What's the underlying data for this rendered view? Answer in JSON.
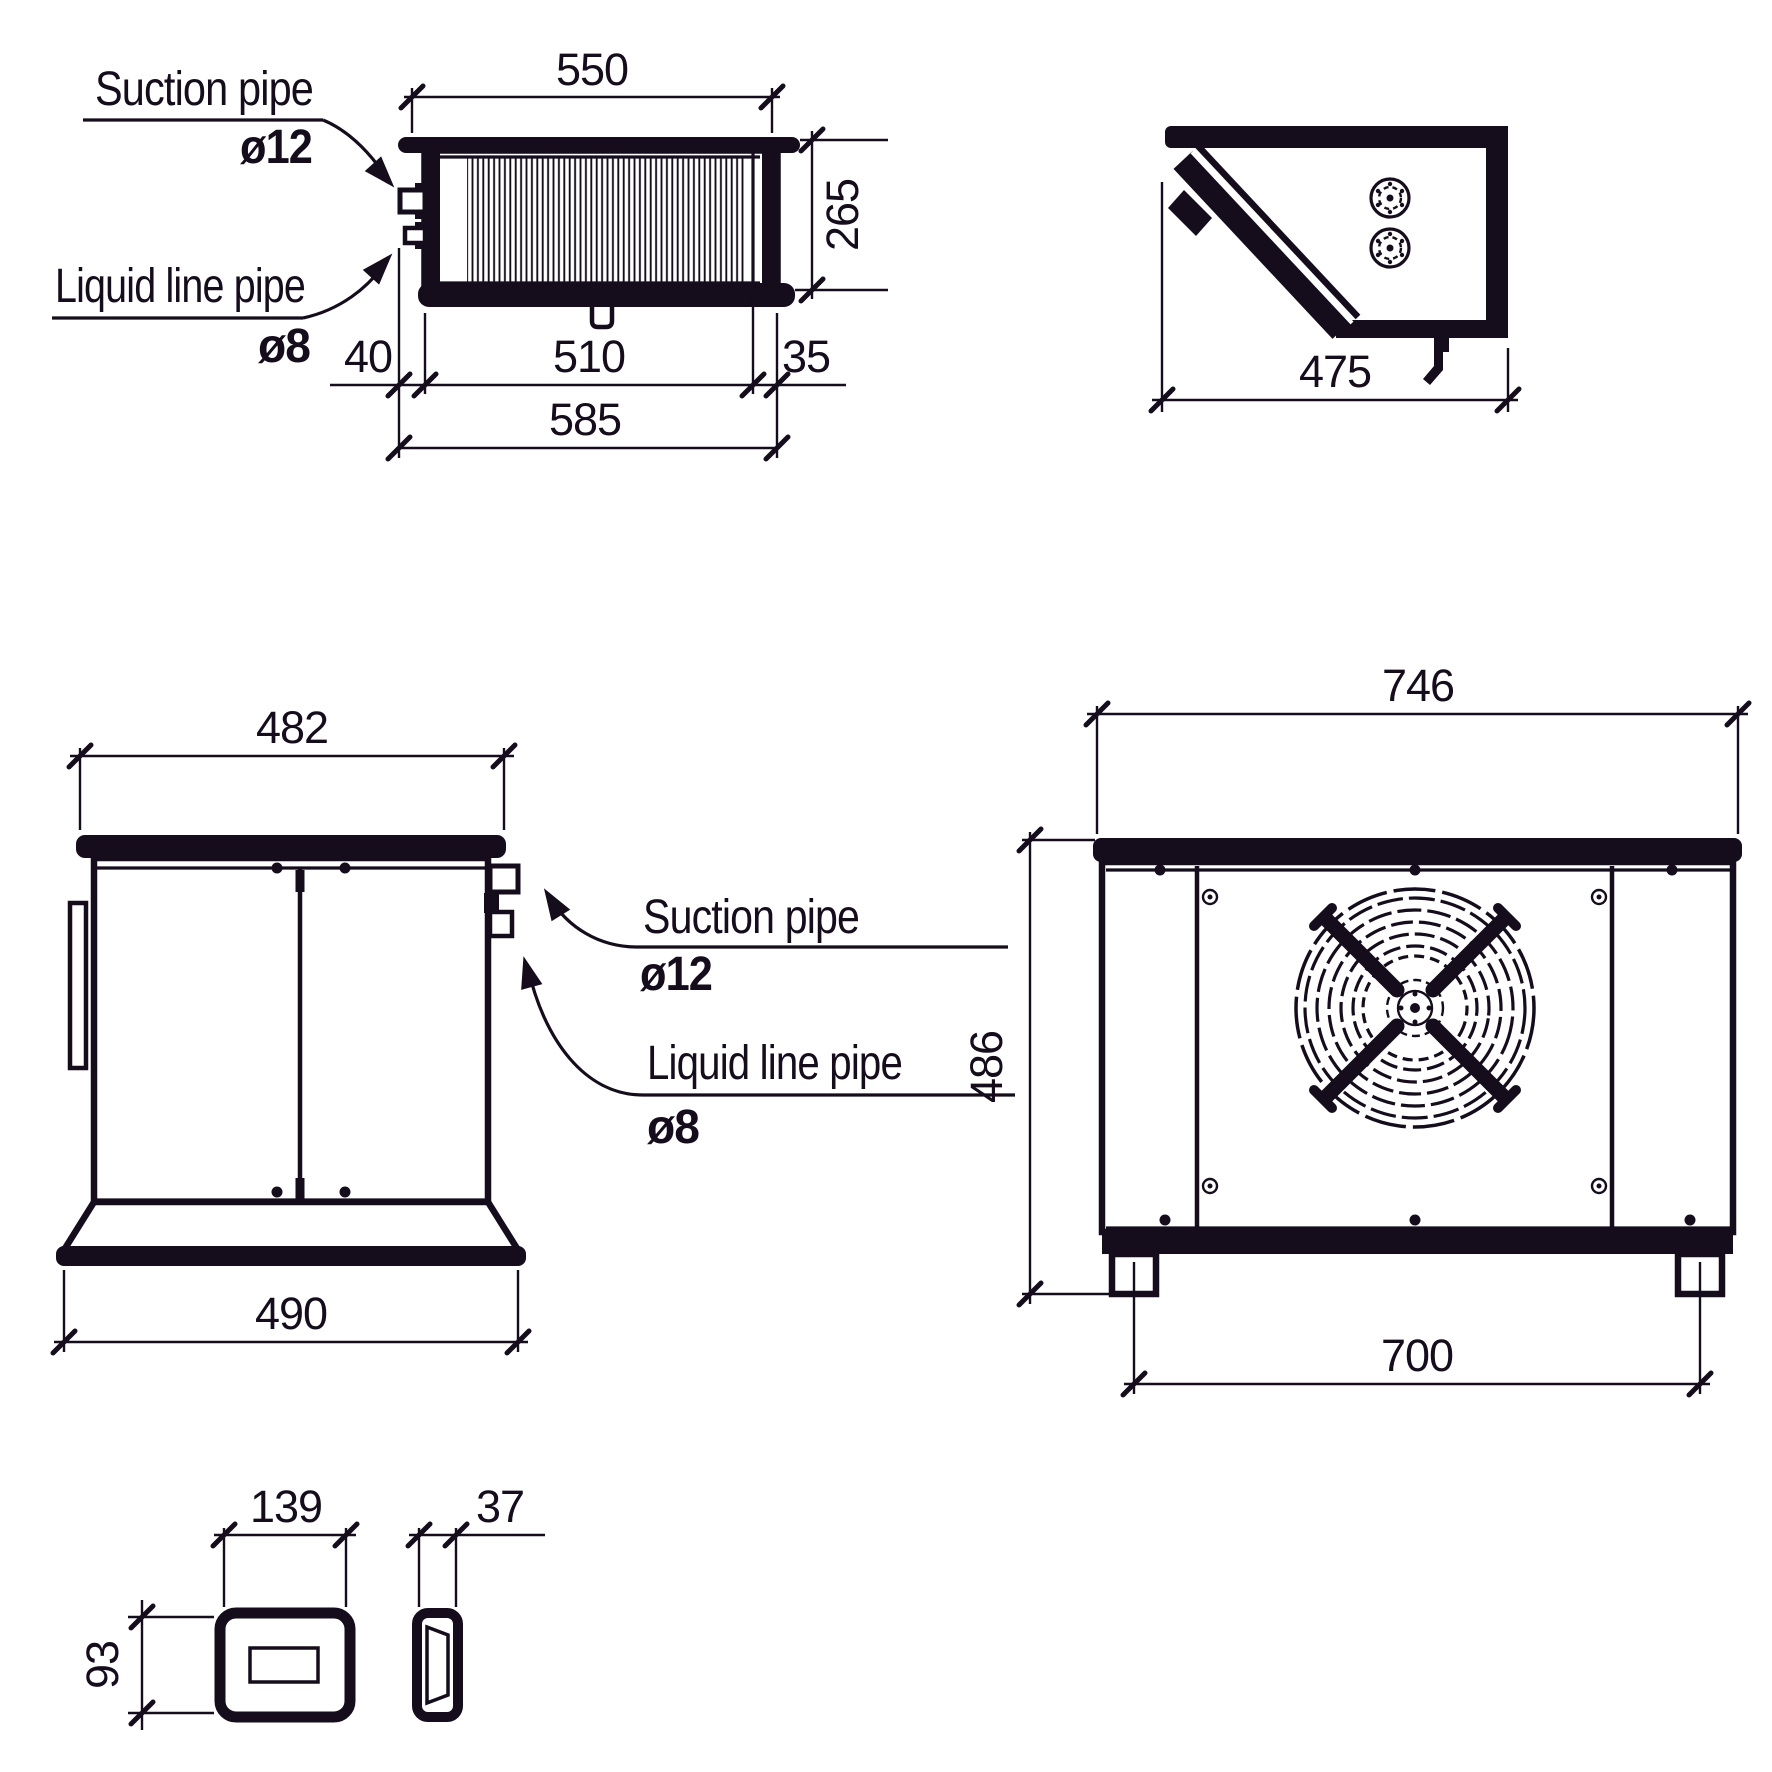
{
  "drawing_type": "technical-dimension-drawing",
  "ink_color": "#150d1c",
  "paper_color": "#ffffff",
  "views": {
    "evaporator_front": {
      "name": "Evaporator unit - front view",
      "labels": {
        "suction": "Suction pipe",
        "suction_diameter": "ø12",
        "liquid": "Liquid line pipe",
        "liquid_diameter": "ø8"
      },
      "dimensions": {
        "coil_width": "550",
        "height": "265",
        "pipe_offset": "40",
        "coil_length": "510",
        "end_margin": "35",
        "overall_width": "585"
      }
    },
    "evaporator_side": {
      "name": "Evaporator unit - side view",
      "dimensions": {
        "depth": "475"
      }
    },
    "condenser_side": {
      "name": "Condensing unit - side view",
      "labels": {
        "suction": "Suction pipe",
        "suction_diameter": "ø12",
        "liquid": "Liquid line pipe",
        "liquid_diameter": "ø8"
      },
      "dimensions": {
        "top_width": "482",
        "base_width": "490"
      }
    },
    "condenser_front": {
      "name": "Condensing unit - front view",
      "dimensions": {
        "overall_width": "746",
        "height": "486",
        "feet_spacing": "700"
      }
    },
    "controller_front": {
      "name": "Controller - front view",
      "dimensions": {
        "width": "139",
        "height": "93"
      }
    },
    "controller_side": {
      "name": "Controller - side view",
      "dimensions": {
        "depth": "37"
      }
    }
  }
}
